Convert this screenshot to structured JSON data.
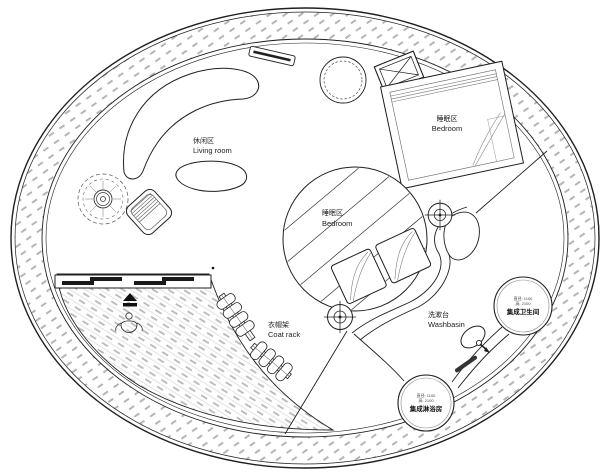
{
  "colors": {
    "wall_line": "#1f1f1f",
    "hatch_gray": "#b5b5b5",
    "deck_gray": "#d4d4d4",
    "door_panel": "#1a1a1a",
    "background": "#ffffff",
    "text": "#222222"
  },
  "labels": {
    "living_room": {
      "zh": "休闲区",
      "en": "Living room"
    },
    "bedroom_upper": {
      "zh": "睡眠区",
      "en": "Bedroom"
    },
    "bedroom_center": {
      "zh": "睡眠区",
      "en": "Bedroom"
    },
    "coat_rack": {
      "zh": "衣帽架",
      "en": "Coat rack"
    },
    "washbasin": {
      "zh": "洗漱台",
      "en": "Washbasin"
    }
  },
  "pods": {
    "bathroom": {
      "spec_diameter": "直径: 1100",
      "spec_height": "高: 2100",
      "name": "集成卫生间"
    },
    "shower": {
      "spec_diameter": "直径: 1100",
      "spec_height": "高: 2100",
      "name": "集成淋浴房"
    }
  },
  "icons": {
    "survey_point": "crosshair-target",
    "entry_arrow": "solid-triangle-arrow",
    "crossed_box": "x-crossed-rectangle",
    "potted_plant": "plan-plant-symbol"
  }
}
